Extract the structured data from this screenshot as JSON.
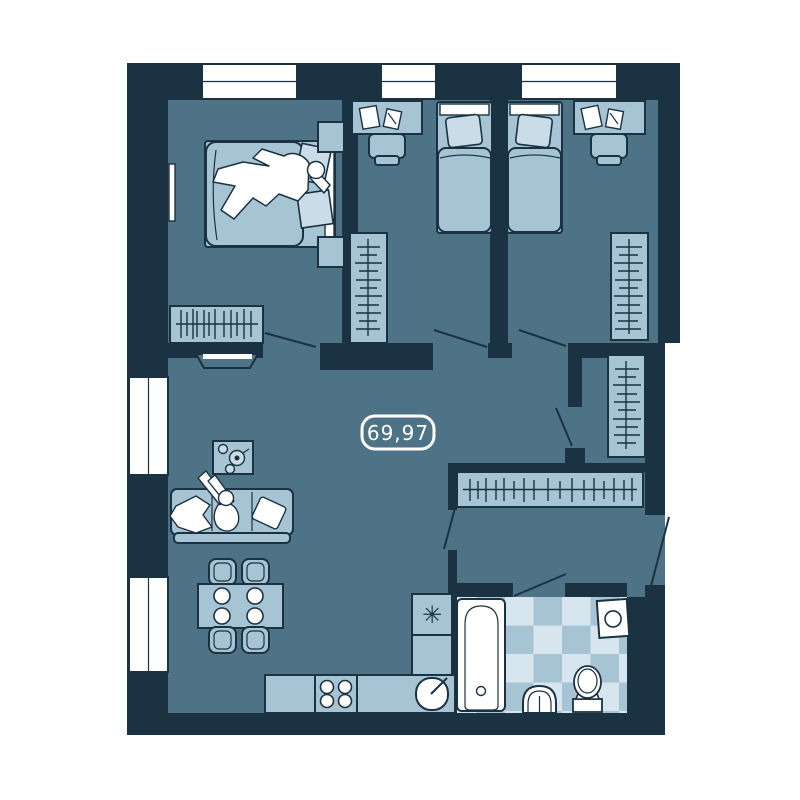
{
  "page": {
    "background": "#ffffff"
  },
  "palette": {
    "wall": "#1a3242",
    "floor": "#4e7286",
    "furniture": "#a7c4d4",
    "furniture_light": "#c9dce7",
    "white": "#ffffff",
    "tile_light": "#d7e5ee",
    "tile_mid": "#a7c4d4",
    "label_stroke": "#ffffff",
    "label_text": "#ffffff"
  },
  "area_label": {
    "text": "69,97"
  },
  "symbols": {
    "fridge": "✳"
  },
  "rooms": [
    {
      "name": "master-bedroom",
      "items": [
        "double-bed",
        "person-lying",
        "pillows",
        "nightstand-top",
        "nightstand-bottom",
        "wardrobe",
        "tv",
        "window-strip"
      ]
    },
    {
      "name": "bedroom-2",
      "items": [
        "single-bed",
        "desk-with-papers",
        "chair",
        "wardrobe",
        "window"
      ]
    },
    {
      "name": "bedroom-3",
      "items": [
        "single-bed",
        "desk-with-papers",
        "chair",
        "wardrobe",
        "window"
      ]
    },
    {
      "name": "living-room",
      "items": [
        "sofa",
        "person-sitting",
        "cushion",
        "blanket",
        "coffee-table",
        "tea-set",
        "dining-table",
        "plates",
        "chairs",
        "windows"
      ]
    },
    {
      "name": "kitchen",
      "items": [
        "fridge",
        "counter",
        "stove",
        "sink"
      ]
    },
    {
      "name": "hallway",
      "items": [
        "coat-rack",
        "wardrobe",
        "entrance-door"
      ]
    },
    {
      "name": "bathroom",
      "items": [
        "bathtub",
        "washbasin",
        "toilet",
        "washing-machine",
        "tiled-floor"
      ]
    }
  ]
}
